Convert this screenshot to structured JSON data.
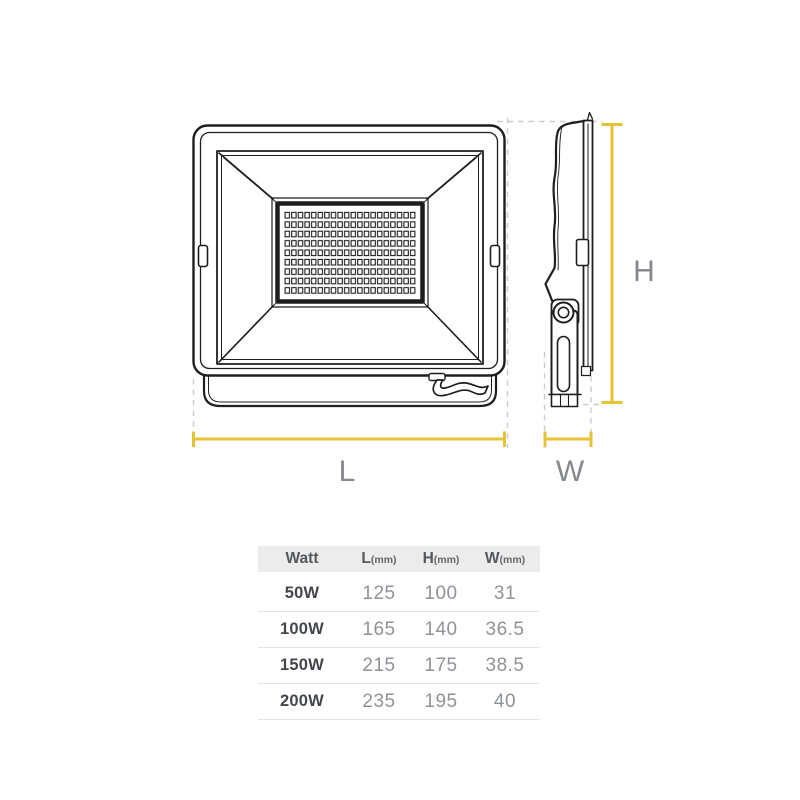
{
  "diagram": {
    "labels": {
      "length": "L",
      "width": "W",
      "height": "H"
    },
    "colors": {
      "dimension_line": "#E6C235",
      "label_text": "#84888C",
      "drawing_line": "#1E1E1E",
      "extension_line": "#C9CDD0"
    }
  },
  "table": {
    "headers": [
      {
        "label": "Watt",
        "unit": ""
      },
      {
        "label": "L",
        "unit": "(mm)"
      },
      {
        "label": "H",
        "unit": "(mm)"
      },
      {
        "label": "W",
        "unit": "(mm)"
      }
    ],
    "rows": [
      {
        "watt": "50W",
        "l": "125",
        "h": "100",
        "w": "31"
      },
      {
        "watt": "100W",
        "l": "165",
        "h": "140",
        "w": "36.5"
      },
      {
        "watt": "150W",
        "l": "215",
        "h": "175",
        "w": "38.5"
      },
      {
        "watt": "200W",
        "l": "235",
        "h": "195",
        "w": "40"
      }
    ]
  }
}
